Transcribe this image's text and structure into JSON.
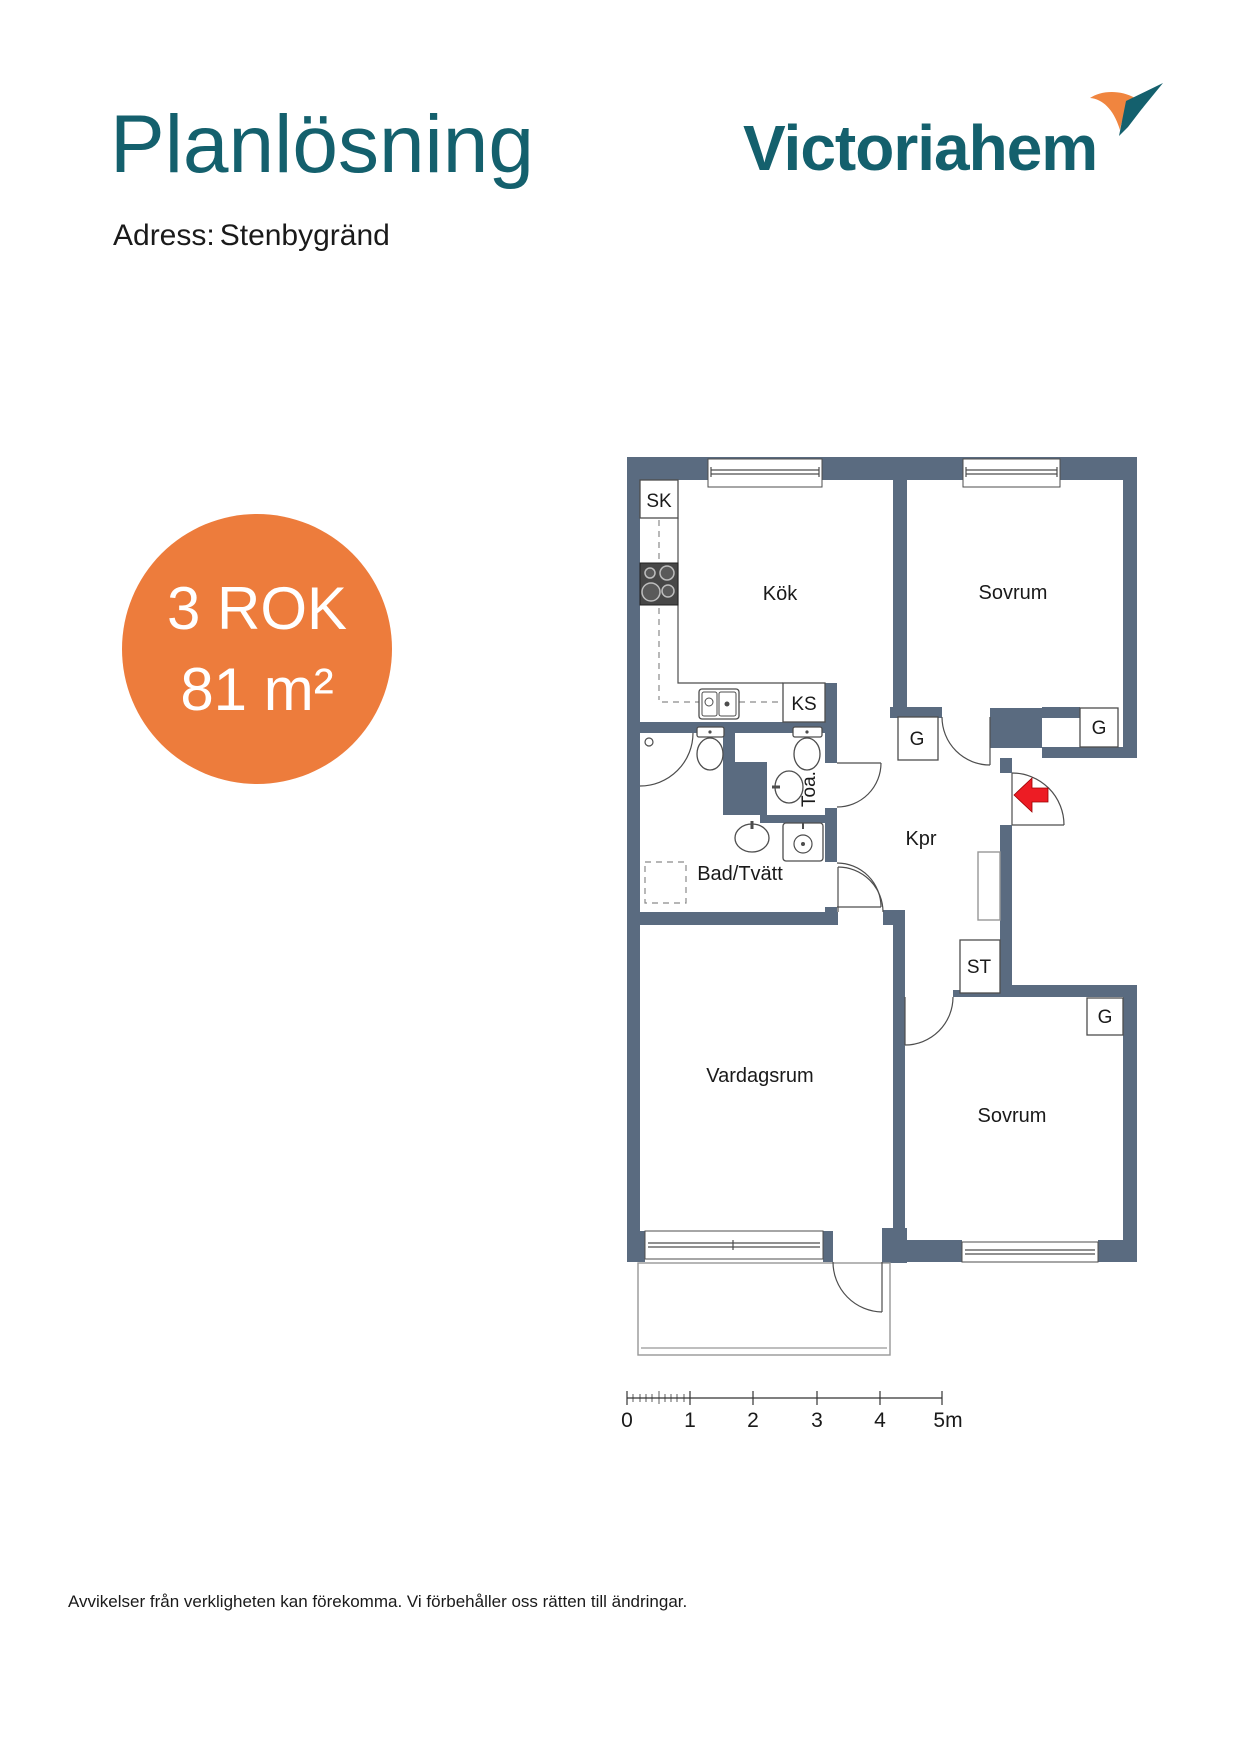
{
  "header": {
    "title": "Planlösning",
    "address_label": "Adress:",
    "address_value": "Stenbygränd",
    "logo_text": "Victoriahem",
    "brand_teal": "#14606d",
    "brand_orange": "#f0853f"
  },
  "badge": {
    "rok": "3 ROK",
    "area": "81 m²",
    "bg_color": "#ed7c3c",
    "text_color": "#ffffff"
  },
  "plan": {
    "wall_color": "#5a6b80",
    "entrance_arrow_color": "#ed1c24",
    "rooms": [
      {
        "label": "Kök"
      },
      {
        "label": "Sovrum"
      },
      {
        "label": "Kpr"
      },
      {
        "label": "Bad/Tvätt"
      },
      {
        "label": "Toa."
      },
      {
        "label": "Vardagsrum"
      },
      {
        "label": "Sovrum"
      }
    ],
    "closets": [
      {
        "label": "SK"
      },
      {
        "label": "KS"
      },
      {
        "label": "G"
      },
      {
        "label": "G"
      },
      {
        "label": "G"
      },
      {
        "label": "ST"
      }
    ],
    "fixtures": [
      "stove",
      "kitchen-sink",
      "shower",
      "toilet",
      "toilet",
      "washbasin",
      "washbasin",
      "washing-machine",
      "appliance-space",
      "entrance-arrow",
      "balcony"
    ]
  },
  "scale_bar": {
    "labels": [
      "0",
      "1",
      "2",
      "3",
      "4",
      "5m"
    ]
  },
  "footer": {
    "disclaimer": "Avvikelser från verkligheten kan förekomma. Vi förbehåller oss rätten till ändringar."
  }
}
